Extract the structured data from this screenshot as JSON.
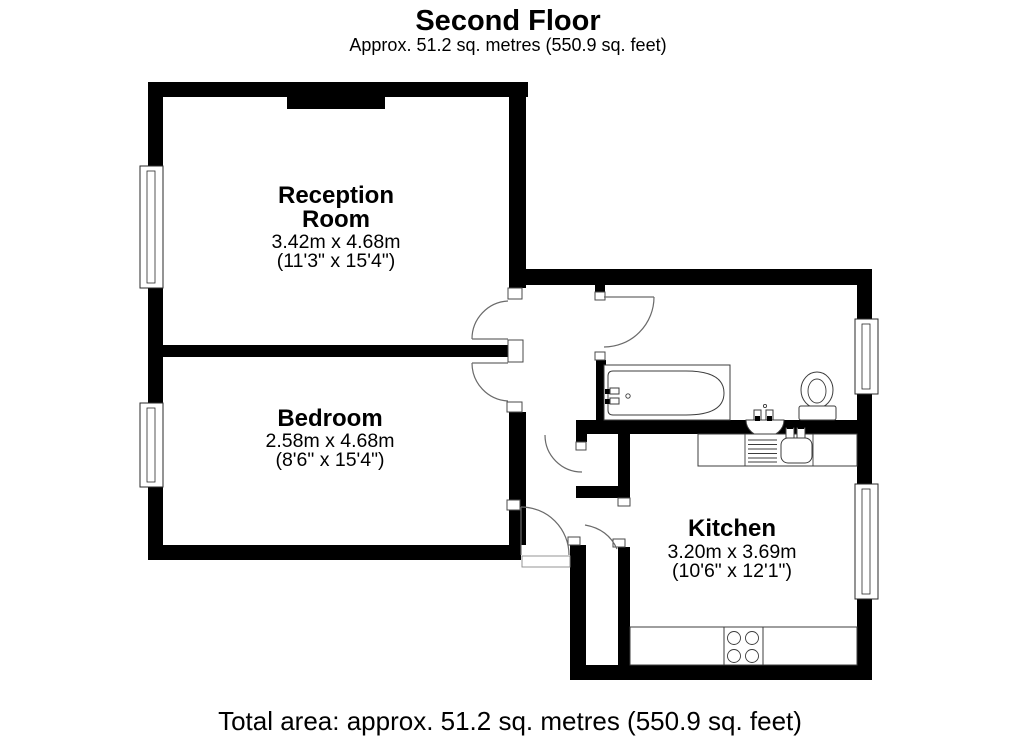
{
  "header": {
    "title": "Second Floor",
    "subtitle": "Approx. 51.2 sq. metres (550.9 sq. feet)"
  },
  "rooms": {
    "reception": {
      "name_line1": "Reception",
      "name_line2": "Room",
      "size_metric": "3.42m x 4.68m",
      "size_imperial": "(11'3\" x 15'4\")"
    },
    "bedroom": {
      "name": "Bedroom",
      "size_metric": "2.58m x 4.68m",
      "size_imperial": "(8'6\" x 15'4\")"
    },
    "kitchen": {
      "name": "Kitchen",
      "size_metric": "3.20m x 3.69m",
      "size_imperial": "(10'6\" x 12'1\")"
    }
  },
  "footer": {
    "total_area": "Total area: approx. 51.2 sq. metres (550.9 sq. feet)"
  },
  "fixtures": {
    "bathroom": [
      "bath",
      "pedestal-basin",
      "toilet"
    ],
    "kitchen": [
      "sink-drainer",
      "sink-bowl",
      "hob"
    ]
  },
  "colors": {
    "background": "#ffffff",
    "wall": "#000000",
    "fixture_stroke": "#3c3c3c",
    "door_arc": "#6a6a6a"
  }
}
